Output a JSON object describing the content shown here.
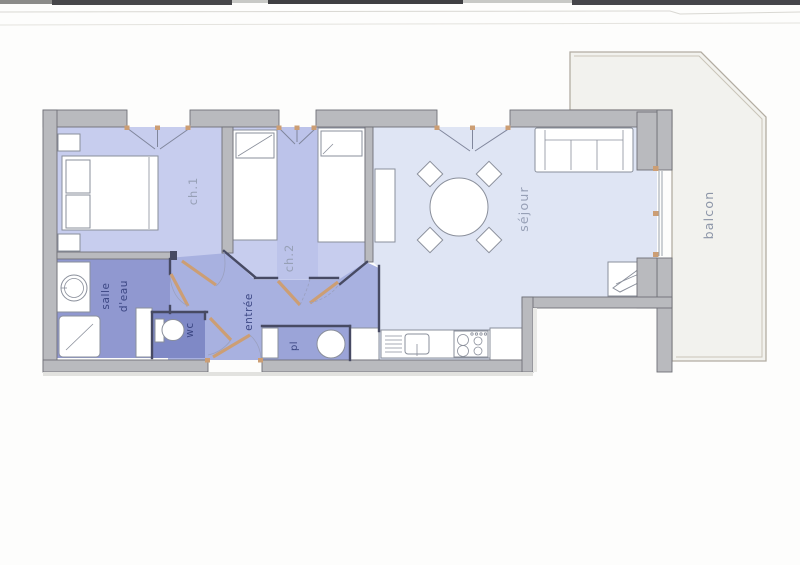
{
  "floorplan": {
    "labels": {
      "ch1": "ch.1",
      "ch2": "ch.2",
      "sejour": "séjour",
      "balcon": "balcon",
      "salle_deau_line1": "salle",
      "salle_deau_line2": "d'eau",
      "wc": "wc",
      "entree": "entrée",
      "placard": "pl"
    },
    "colors": {
      "wall": "#b9babe",
      "wall_edge": "#6f7077",
      "bedroom_fill": "#c7cdee",
      "bedroom_strip_fill": "#bcc3ea",
      "sejour_fill": "#dfe5f4",
      "entree_fill": "#a8b1e0",
      "salle_deau_fill": "#9098d0",
      "wc_fill": "#7f89c6",
      "placard_fill": "#9ba4d8",
      "balcony_fill": "#f2f2ee",
      "joinery_tan": "#cc9e74",
      "label_muted": "#97a0b6",
      "label_navy": "#3c4784"
    },
    "furniture": [
      "double-bed",
      "nightstand",
      "single-bed",
      "sofa",
      "sideboard",
      "round-table",
      "chair",
      "tv-stand",
      "kitchen-sink",
      "cooktop",
      "appliance",
      "washbasin",
      "shower",
      "toilet",
      "water-heater"
    ]
  }
}
